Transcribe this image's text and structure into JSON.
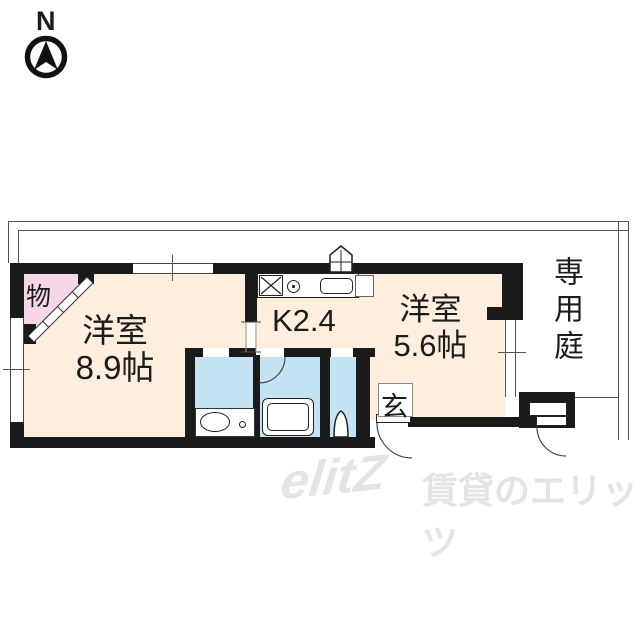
{
  "compass": {
    "label": "N"
  },
  "plan": {
    "closet": {
      "label": "物"
    },
    "main_room": {
      "name": "洋室",
      "size": "8.9帖"
    },
    "kitchen": {
      "label": "K2.4"
    },
    "sub_room": {
      "name": "洋室",
      "size": "5.6帖"
    },
    "entrance": {
      "label": "玄"
    },
    "garden": {
      "label": "専用庭"
    },
    "colors": {
      "room_fill": "#fdeedd",
      "closet_fill": "#f6d7e8",
      "wet_area_fill": "#c5e4f3",
      "wall": "#1a1a1a"
    }
  },
  "watermark": {
    "logo": "elitZ",
    "text": "賃貸のエリッツ",
    "color": "#e4e4e4"
  }
}
